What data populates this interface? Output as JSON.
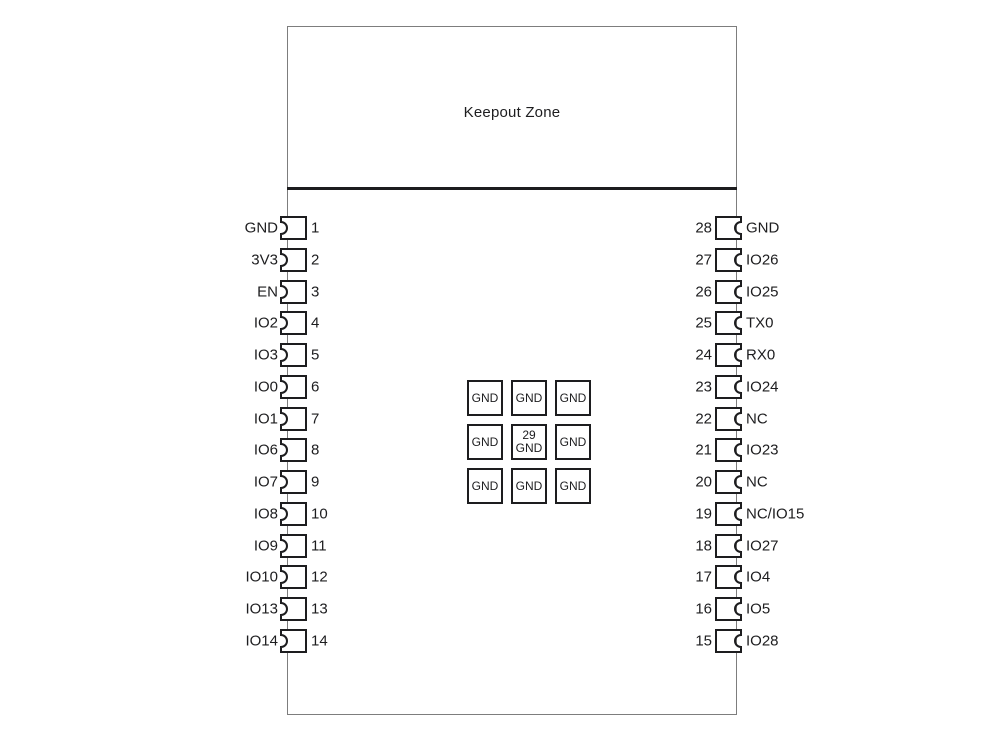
{
  "diagram": {
    "title": "Keepout Zone",
    "colors": {
      "outline": "#7d7d7d",
      "ink": "#1d1d1f",
      "background": "#ffffff"
    },
    "left_pins": [
      {
        "label": "GND",
        "number": "1"
      },
      {
        "label": "3V3",
        "number": "2"
      },
      {
        "label": "EN",
        "number": "3"
      },
      {
        "label": "IO2",
        "number": "4"
      },
      {
        "label": "IO3",
        "number": "5"
      },
      {
        "label": "IO0",
        "number": "6"
      },
      {
        "label": "IO1",
        "number": "7"
      },
      {
        "label": "IO6",
        "number": "8"
      },
      {
        "label": "IO7",
        "number": "9"
      },
      {
        "label": "IO8",
        "number": "10"
      },
      {
        "label": "IO9",
        "number": "11"
      },
      {
        "label": "IO10",
        "number": "12"
      },
      {
        "label": "IO13",
        "number": "13"
      },
      {
        "label": "IO14",
        "number": "14"
      }
    ],
    "right_pins": [
      {
        "number": "28",
        "label": "GND"
      },
      {
        "number": "27",
        "label": "IO26"
      },
      {
        "number": "26",
        "label": "IO25"
      },
      {
        "number": "25",
        "label": "TX0"
      },
      {
        "number": "24",
        "label": "RX0"
      },
      {
        "number": "23",
        "label": "IO24"
      },
      {
        "number": "22",
        "label": "NC"
      },
      {
        "number": "21",
        "label": "IO23"
      },
      {
        "number": "20",
        "label": "NC"
      },
      {
        "number": "19",
        "label": "NC/IO15"
      },
      {
        "number": "18",
        "label": "IO27"
      },
      {
        "number": "17",
        "label": "IO4"
      },
      {
        "number": "16",
        "label": "IO5"
      },
      {
        "number": "15",
        "label": "IO28"
      }
    ],
    "center_pads": [
      [
        "GND",
        "GND",
        "GND"
      ],
      [
        "GND",
        "29|GND",
        "GND"
      ],
      [
        "GND",
        "GND",
        "GND"
      ]
    ]
  }
}
